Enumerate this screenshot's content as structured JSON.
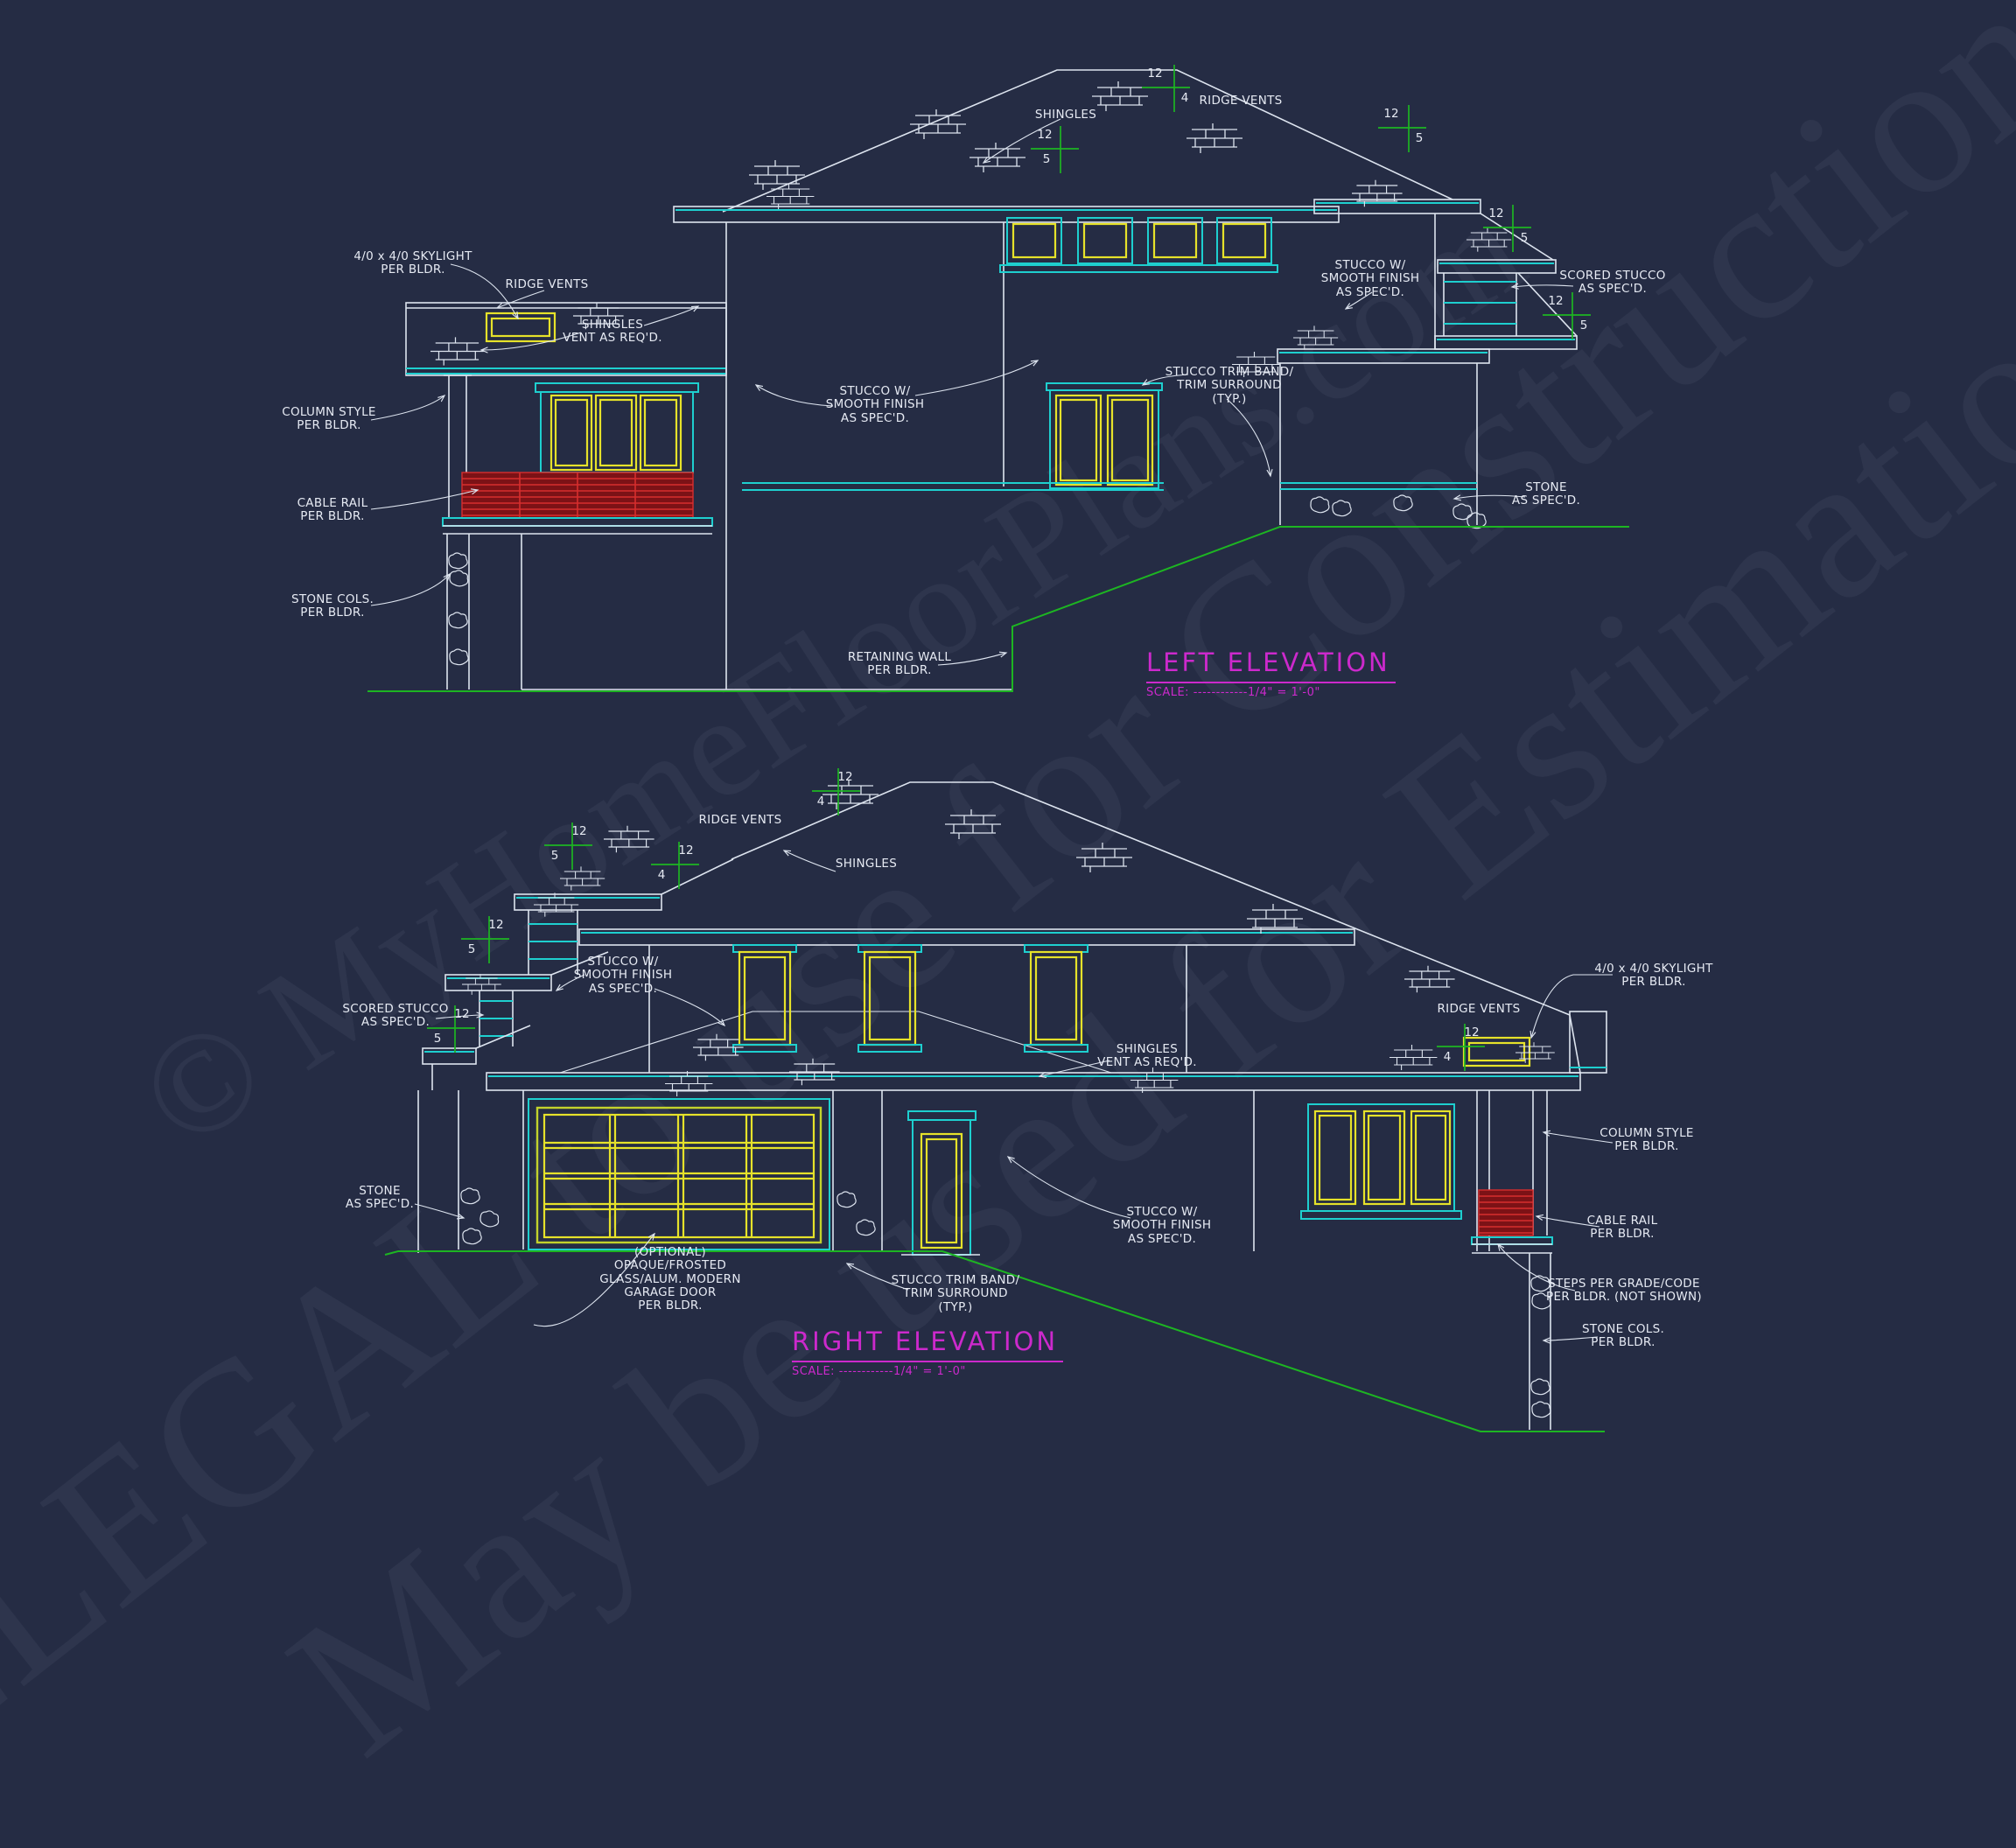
{
  "watermarks": {
    "line1": "© MyHomeFloorPlans.com",
    "line2": "ILLEGAL to use for Construction",
    "line3": "May be used for Estimations"
  },
  "left_elevation": {
    "title": "LEFT ELEVATION",
    "scale": "SCALE: ------------1/4\" = 1'-0\"",
    "labels": {
      "skylight": "4/0 x 4/0 SKYLIGHT\nPER BLDR.",
      "ridge_vents": "RIDGE VENTS",
      "shingles_vent": "SHINGLES\nVENT AS REQ'D.",
      "column_style": "COLUMN STYLE\nPER BLDR.",
      "cable_rail": "CABLE RAIL\nPER BLDR.",
      "stone_cols": "STONE COLS.\nPER BLDR.",
      "shingles": "SHINGLES",
      "ridge_vents_top": "RIDGE VENTS",
      "stucco_center": "STUCCO W/\nSMOOTH FINISH\nAS SPEC'D.",
      "trim_band": "STUCCO TRIM BAND/\nTRIM SURROUND\n(TYP.)",
      "stucco_right": "STUCCO W/\nSMOOTH FINISH\nAS SPEC'D.",
      "scored_stucco": "SCORED STUCCO\nAS SPEC'D.",
      "stone": "STONE\nAS SPEC'D.",
      "retaining": "RETAINING WALL\nPER BLDR."
    },
    "slopes": {
      "s1": {
        "rise": "12",
        "run": "4"
      },
      "s2": {
        "rise": "12",
        "run": "5"
      },
      "s3": {
        "rise": "12",
        "run": "5"
      },
      "s4": {
        "rise": "12",
        "run": "5"
      },
      "s5": {
        "rise": "12",
        "run": "5"
      }
    }
  },
  "right_elevation": {
    "title": "RIGHT ELEVATION",
    "scale": "SCALE: ------------1/4\" = 1'-0\"",
    "labels": {
      "ridge_vents": "RIDGE VENTS",
      "shingles": "SHINGLES",
      "scored_stucco": "SCORED STUCCO\nAS SPEC'D.",
      "stucco_center": "STUCCO W/\nSMOOTH FINISH\nAS SPEC'D.",
      "shingles_vent": "SHINGLES\nVENT AS REQ'D.",
      "stucco_right": "STUCCO W/\nSMOOTH FINISH\nAS SPEC'D.",
      "stone": "STONE\nAS SPEC'D.",
      "garage_door": "(OPTIONAL)\nOPAQUE/FROSTED\nGLASS/ALUM. MODERN\nGARAGE DOOR\nPER BLDR.",
      "trim_band": "STUCCO TRIM BAND/\nTRIM SURROUND\n(TYP.)",
      "skylight": "4/0 x 4/0 SKYLIGHT\nPER BLDR.",
      "ridge_vents_right": "RIDGE VENTS",
      "column_style": "COLUMN STYLE\nPER BLDR.",
      "cable_rail": "CABLE RAIL\nPER BLDR.",
      "steps": "STEPS PER GRADE/CODE\nPER BLDR. (NOT SHOWN)",
      "stone_cols": "STONE COLS.\nPER BLDR."
    },
    "slopes": {
      "t1": {
        "rise": "12",
        "run": "4"
      },
      "t2": {
        "rise": "12",
        "run": "5"
      },
      "t3": {
        "rise": "12",
        "run": "4"
      },
      "t4": {
        "rise": "12",
        "run": "5"
      },
      "t5": {
        "rise": "12",
        "run": "5"
      },
      "t6": {
        "rise": "12",
        "run": "4"
      }
    }
  }
}
